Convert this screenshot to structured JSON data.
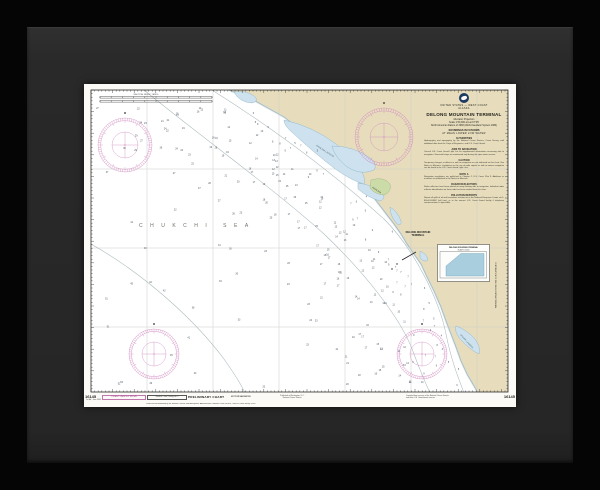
{
  "artwork": {
    "kind": "framed nautical chart print",
    "frame_outer_color": "#050505",
    "frame_face_color": "#292929",
    "paper_color": "#fbfaf6"
  },
  "palette": {
    "land": "#e7ddbd",
    "lagoon": "#cde2ee",
    "lagoon_stroke": "#8fb6c9",
    "marsh": "#cbdca8",
    "coast": "#7d7d6a",
    "graticule": "#cdcdc8",
    "contour": "#a9b8bc",
    "rose_magenta": "#cf86bd",
    "sounding": "#4a5560",
    "neatline": "#2b2b28"
  },
  "chart": {
    "number": "16145",
    "title_block": {
      "dept_line": "U.S. DEPARTMENT OF COMMERCE",
      "agency_line": "NATIONAL OCEANIC AND ATMOSPHERIC ADMINISTRATION",
      "region_line": "UNITED STATES — WEST COAST",
      "state_line": "ALASKA",
      "title": "DELONG MOUNTAIN TERMINAL",
      "projection_line": "Mercator Projection",
      "scale_line": "Scale 1:50,000 at Lat 67°45'",
      "datum_line": "North American Datum of 1983 (World Geodetic System 1984)",
      "soundings_line": "SOUNDINGS IN FATHOMS",
      "datum_note": "AT MEAN LOWER LOW WATER"
    },
    "notes": [
      {
        "heading": "AUTHORITIES",
        "body": "Hydrography and topography by the National Ocean Service, Coast Survey, with additional data from the Corps of Engineers, and U.S. Coast Guard."
      },
      {
        "heading": "AIDS TO NAVIGATION",
        "body": "Consult U.S. Coast Guard Light List for supplemental information concerning aids to navigation. Seasonal buoys are maintained only during the open water season."
      },
      {
        "heading": "CAUTION",
        "body": "Temporary changes or defects in aids to navigation are not indicated on this chart. See Notice to Mariners. Limitations on the use of radio signals as aids to marine navigation can be found in the U.S. Coast Guard Light Lists."
      },
      {
        "heading": "NOTE A",
        "body": "Navigation regulations are published in Chapter 2, U.S. Coast Pilot 9. Additions or revisions are published in the Notice to Mariners."
      },
      {
        "heading": "RADAR REFLECTORS",
        "body": "Radar reflectors have been placed on many floating aids to navigation. Individual radar reflector identification on these aids has been omitted from this chart."
      },
      {
        "heading": "POLLUTION REPORTS",
        "body": "Report all spills of oil and hazardous substances to the National Response Center via 1-800-424-8802 (toll free), or to the nearest U.S. Coast Guard facility if telephone communication is impossible."
      }
    ],
    "labels": {
      "sea": "CHUKCHI SEA",
      "lagoon_upper": "KIVALINA LAGOON",
      "lagoon_mid": "KIVALINA",
      "lagoon_lower": "IPIAVIK LAGOON",
      "terminal_line1": "DELONG MOUNTAIN",
      "terminal_line2": "TERMINAL"
    },
    "inset": {
      "title": "DELONG MOUNTAIN TERMINAL",
      "subtitle": "SCALE 1:20,000"
    },
    "side_note": "CONTINUATION OF DELONG MOUNTAIN TERMINAL",
    "scalebar_caption": "NAUTICAL MILES / YARDS",
    "bottom_margin": {
      "number_left": "16145",
      "number_right": "16145",
      "left_note": "1st Ed., June 2005",
      "box_magenta": "LORAN-C LINES NOT SHOWN",
      "box_black": "Nautical Chart Catalog No. 3",
      "preliminary": "PRELIMINARY CHART",
      "magenta_note": "NOT FOR NAVIGATION",
      "center_note_1": "Published at Washington, D.C.",
      "center_note_2": "National Ocean Service",
      "right_note_1": "Compiled from surveys of the National Ocean Service",
      "right_note_2": "and other U.S. Government sources",
      "imprint": "Produced and distributed by the National Oceanic and Atmospheric Administration, National Ocean Service, Office of Coast Survey 16145"
    }
  },
  "soundings_gen": {
    "seed": 11,
    "attempts": 760
  }
}
